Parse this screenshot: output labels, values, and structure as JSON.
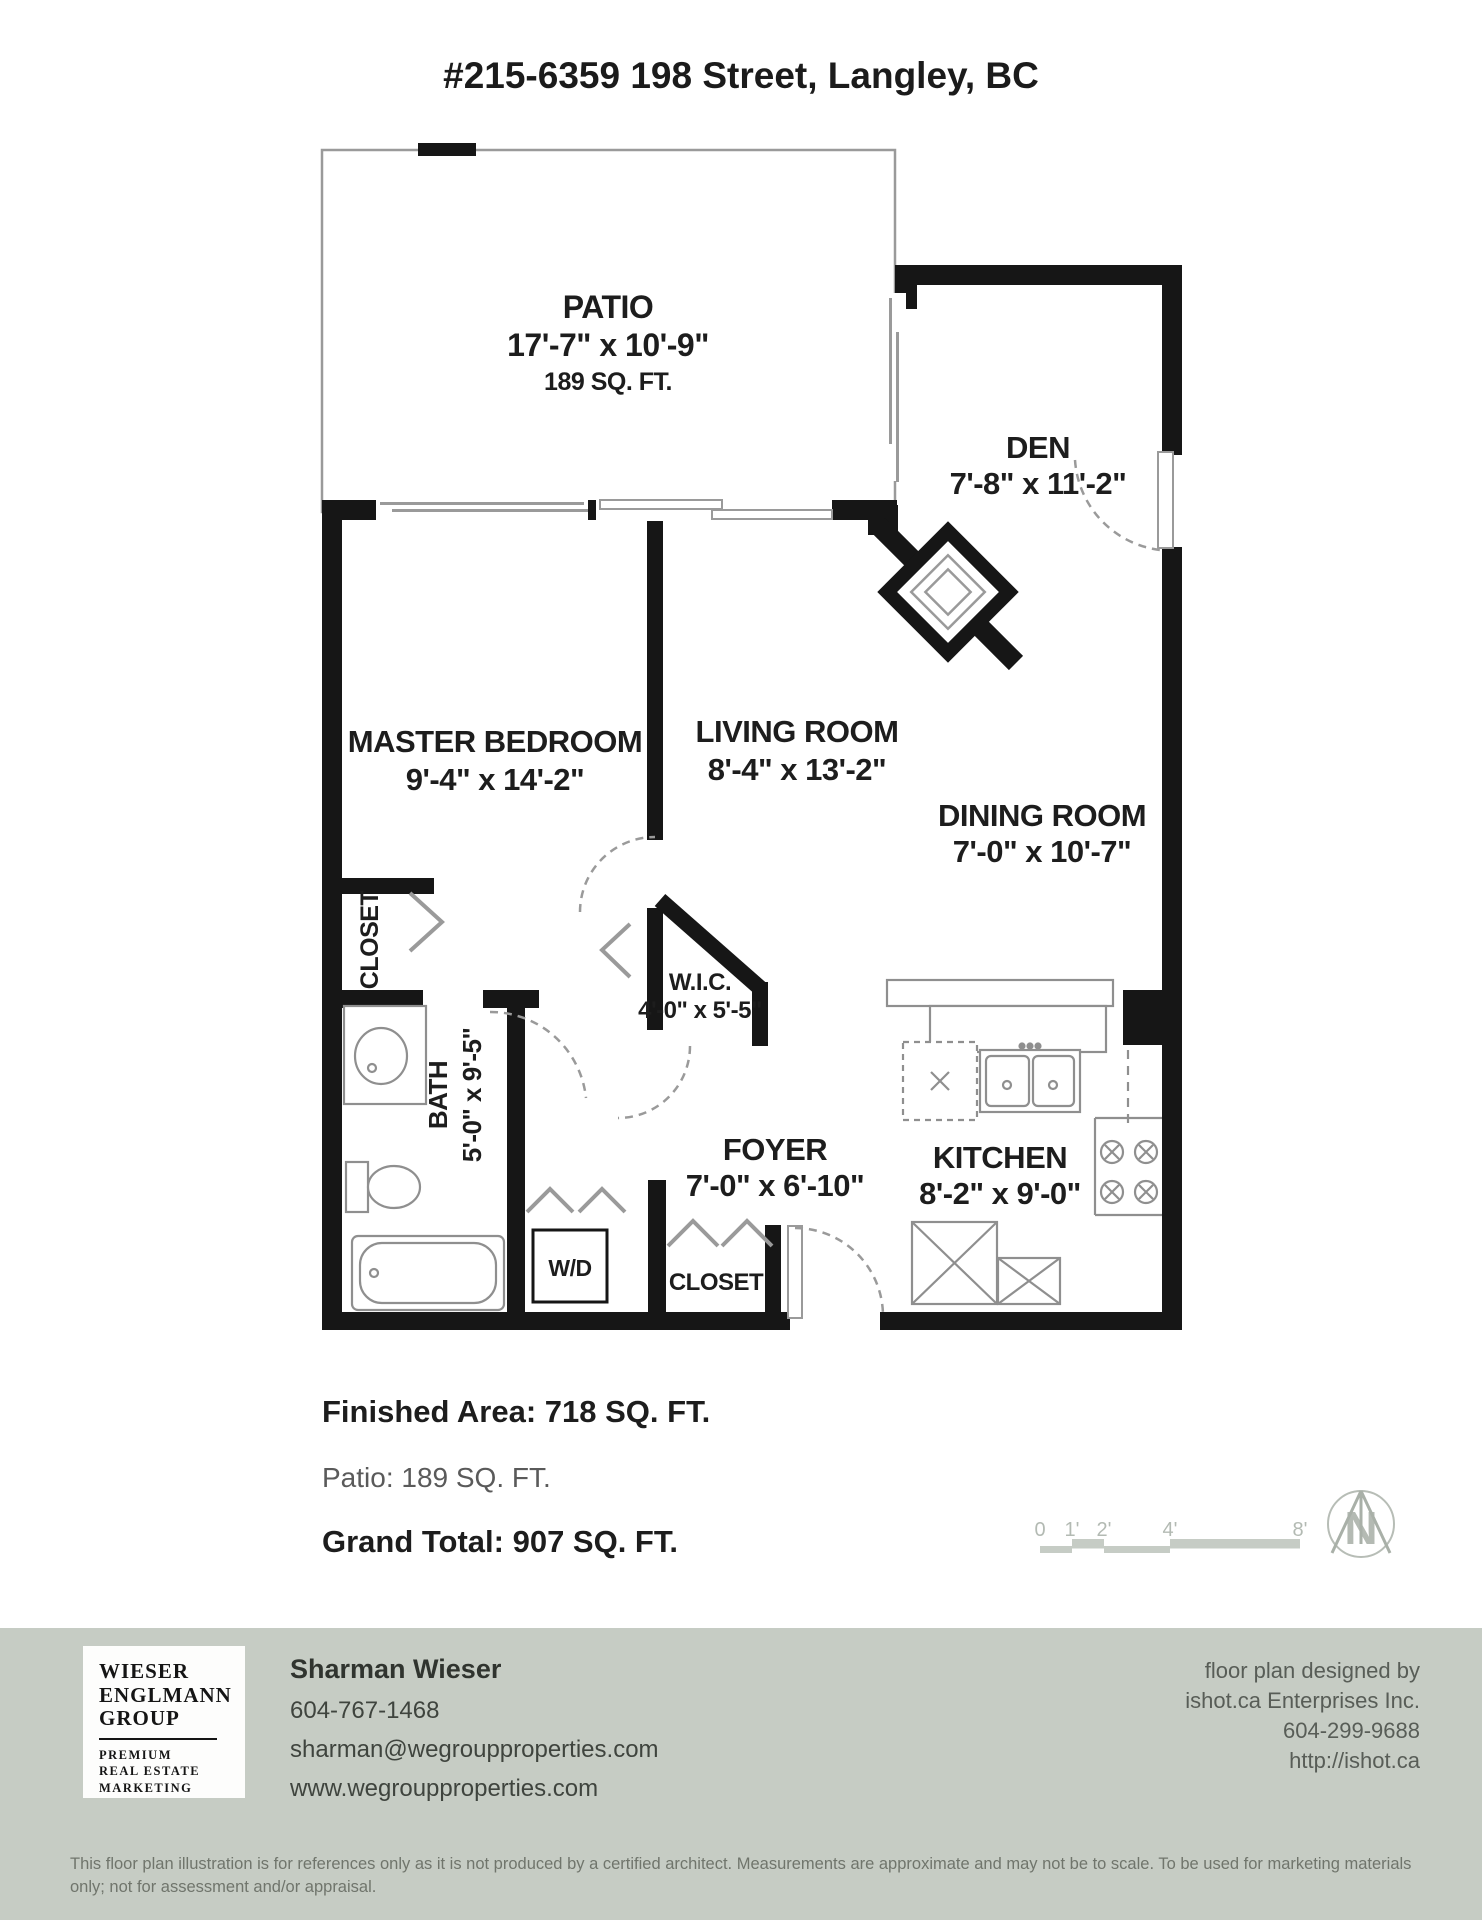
{
  "title": "#215-6359 198 Street, Langley, BC",
  "rooms": {
    "patio": {
      "label": "PATIO",
      "dims": "17'-7\" x 10'-9\"",
      "area": "189 SQ. FT."
    },
    "den": {
      "label": "DEN",
      "dims": "7'-8\" x 11'-2\""
    },
    "master_bedroom": {
      "label": "MASTER BEDROOM",
      "dims": "9'-4\" x 14'-2\""
    },
    "living_room": {
      "label": "LIVING ROOM",
      "dims": "8'-4\" x 13'-2\""
    },
    "dining_room": {
      "label": "DINING ROOM",
      "dims": "7'-0\" x 10'-7\""
    },
    "wic": {
      "label": "W.I.C.",
      "dims": "4'-0\" x 5'-5\""
    },
    "bath": {
      "label": "BATH",
      "dims": "5'-0\" x 9'-5\""
    },
    "foyer": {
      "label": "FOYER",
      "dims": "7'-0\" x 6'-10\""
    },
    "kitchen": {
      "label": "KITCHEN",
      "dims": "8'-2\" x 9'-0\""
    },
    "master_closet": {
      "label": "CLOSET"
    },
    "foyer_closet": {
      "label": "CLOSET"
    },
    "washer_dryer": {
      "label": "W/D"
    }
  },
  "summary": {
    "finished_area": "Finished Area: 718 SQ. FT.",
    "patio_area": "Patio: 189 SQ. FT.",
    "grand_total": "Grand Total: 907 SQ. FT."
  },
  "scale_bar": {
    "ticks": [
      "0",
      "1'",
      "2'",
      "4'",
      "8'"
    ]
  },
  "compass": {
    "north_label": "N"
  },
  "footer": {
    "logo": {
      "line1": "WIESER",
      "line2": "ENGLMANN",
      "line3": "GROUP",
      "sub1": "PREMIUM",
      "sub2": "REAL ESTATE",
      "sub3": "MARKETING"
    },
    "agent": {
      "name": "Sharman Wieser",
      "phone": "604-767-1468",
      "email": "sharman@wegroupproperties.com",
      "website": "www.wegroupproperties.com"
    },
    "designer": {
      "line1": "floor plan designed by",
      "line2": "ishot.ca Enterprises Inc.",
      "line3": "604-299-9688",
      "line4": "http://ishot.ca"
    },
    "disclaimer": "This floor plan illustration is for references only as it is not produced by a certified architect. Measurements are approximate and may not be to scale. To be used for marketing materials only; not for assessment and/or appraisal."
  },
  "colors": {
    "wall": "#161616",
    "fixture_line": "#8f8f8f",
    "door_line": "#9a9a9a",
    "footer_bg": "#c6ccc4",
    "text": "#1d1d1d",
    "muted_text": "#585d57",
    "scale_gray": "#b3bab3"
  }
}
